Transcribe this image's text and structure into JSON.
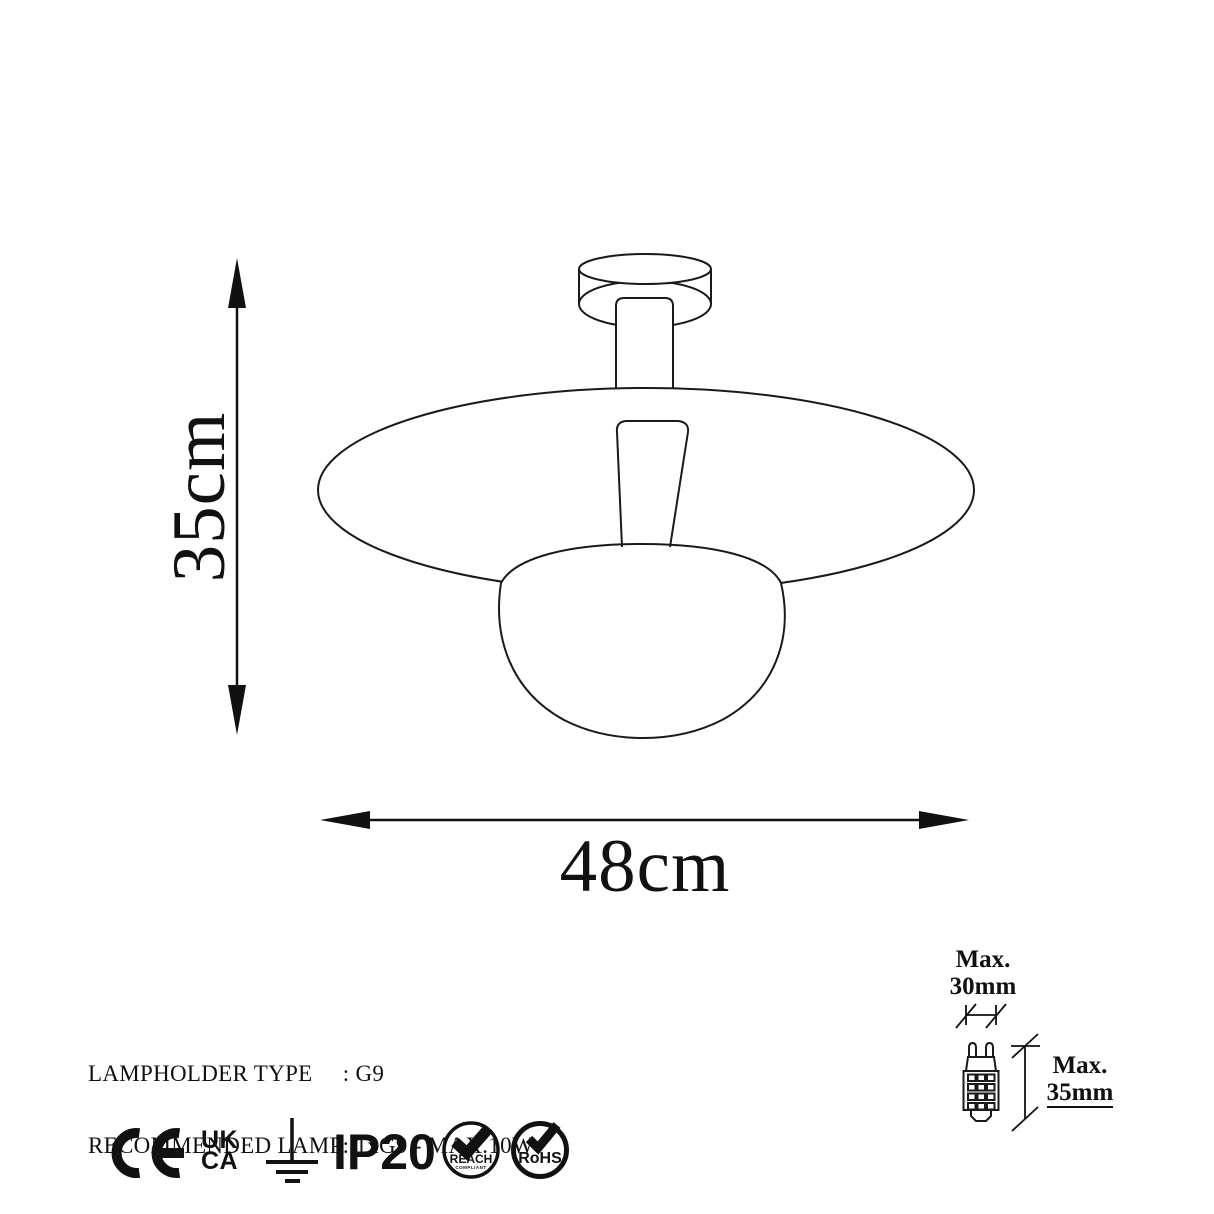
{
  "product_diagram": {
    "dimensions": {
      "height_label": "35cm",
      "width_label": "48cm"
    },
    "specs": {
      "line1": "LAMPHOLDER TYPE     : G9",
      "line2": "RECOMMENDED LAMP: 1xG9 - MAX.10W"
    },
    "bulb_dimensions": {
      "max_width_line1": "Max.",
      "max_width_line2": "30mm",
      "max_height_line1": "Max.",
      "max_height_line2": "35mm"
    },
    "certifications": {
      "ce_mark": "CE",
      "ukca_line1": "UK",
      "ukca_line2": "CA",
      "ip_rating": "IP20",
      "reach_label": "REACH",
      "reach_sub": "COMPLIANT",
      "rohs_label": "RoHS"
    },
    "icons": [
      "ce-mark-icon",
      "ukca-mark-icon",
      "earth-ground-icon",
      "reach-compliant-icon",
      "rohs-icon",
      "g9-bulb-icon"
    ],
    "colors": {
      "line": "#1a1a1a",
      "background": "#ffffff"
    }
  }
}
